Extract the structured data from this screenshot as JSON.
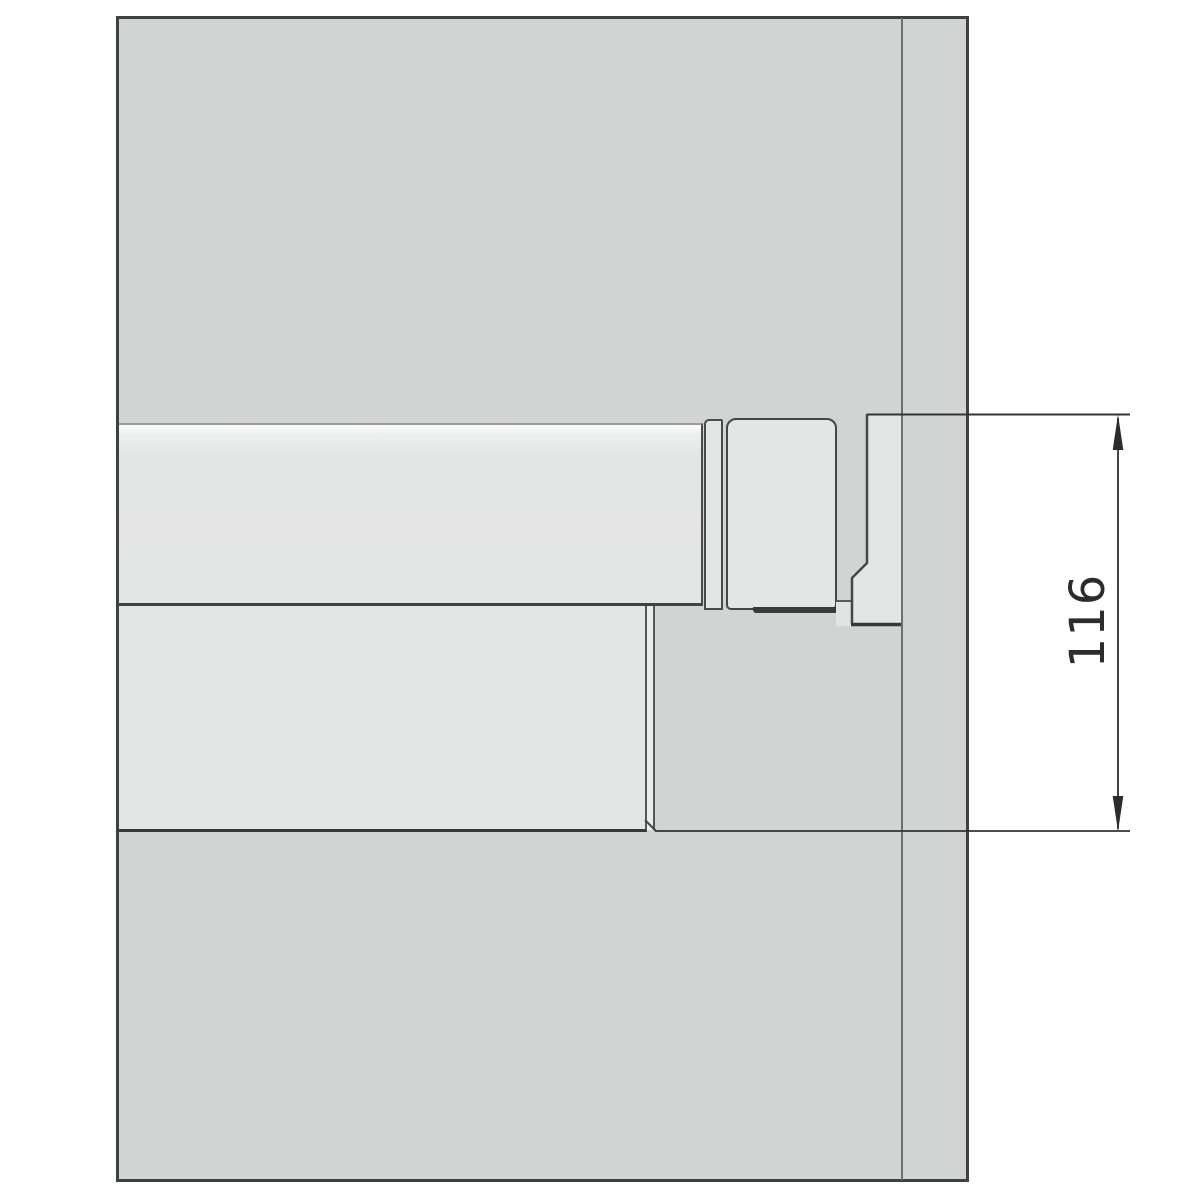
{
  "canvas": {
    "width": 1200,
    "height": 1200,
    "background": "#ffffff"
  },
  "dimension": {
    "value": "116",
    "orientation": "vertical",
    "line_color": "#2f2f2f",
    "text_color": "#2c2c2c"
  },
  "colors": {
    "panel_fill": "#d2d3d3",
    "panel_border": "#3f4040",
    "panel_edge_line": "#6e7070",
    "component_fill": "#e4e5e5",
    "component_highlight": "#fbfbfb",
    "edge_dark": "#434343"
  }
}
